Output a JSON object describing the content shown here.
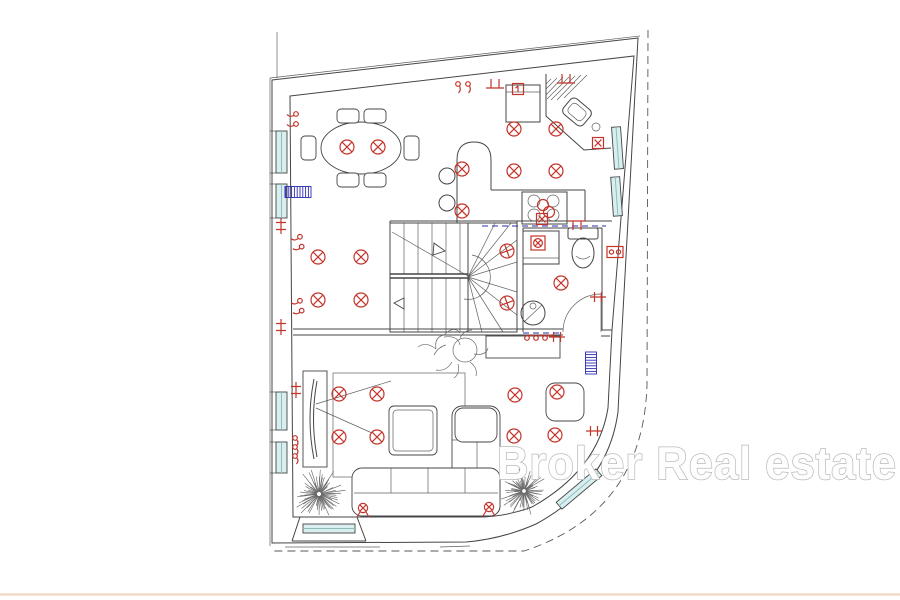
{
  "watermark": {
    "text": "Broker Real estate"
  },
  "canvas": {
    "width": 900,
    "height": 600,
    "background": "#ffffff"
  },
  "colors": {
    "line": "#454545",
    "red": "#c3342b",
    "navy": "#2b2bb2",
    "window": "#d9efef",
    "window_mid": "#8fbcbc",
    "page_rule": "#f2d8c6",
    "tree": "#6a6a6a",
    "watermark_stroke": "#b9b9b9",
    "watermark_fill": "#fefefe"
  },
  "legend": {
    "ceiling-light-icon": "red circle with diagonal cross = ceiling light point",
    "wall-lamp-icon": "red crossed circle with legs on wall = wall lamp",
    "socket-x-icon": "red box with X = power outlet",
    "socket-oo-icon": "red box with two circles = double socket",
    "switch-curl-icon": "red curls = light switches",
    "tick-icon": "red crossed tick = wall connection point",
    "fan-vent-icon": "red boxed fan in shower = extractor vent",
    "fridge-tag-icon": "red boxed 1 = appliance tag",
    "radiator-icon": "blue hatched bar = radiator",
    "window-glyph": "cyan band in wall = window",
    "tree-glyph": "hatched circle = tree / shrub"
  },
  "ceiling_lights": [
    [
      347,
      147
    ],
    [
      378,
      147
    ],
    [
      318,
      257
    ],
    [
      361,
      257
    ],
    [
      318,
      300
    ],
    [
      361,
      300
    ],
    [
      462,
      169
    ],
    [
      462,
      211
    ],
    [
      514,
      129
    ],
    [
      556,
      129
    ],
    [
      514,
      171
    ],
    [
      556,
      171
    ],
    [
      561,
      283
    ],
    [
      339,
      394
    ],
    [
      377,
      394
    ],
    [
      339,
      437
    ],
    [
      377,
      437
    ],
    [
      515,
      395
    ],
    [
      557,
      392
    ],
    [
      514,
      436
    ],
    [
      555,
      435
    ]
  ],
  "stair_lights": [
    [
      507,
      251
    ],
    [
      507,
      303
    ]
  ],
  "glyphs": [
    {
      "type": "curl2",
      "x": 464,
      "y": 86,
      "rot": 0
    },
    {
      "type": "tick-tt",
      "x": 495,
      "y": 85,
      "rot": 0
    },
    {
      "type": "tick-tt",
      "x": 566,
      "y": 80,
      "rot": 0
    },
    {
      "type": "curl2",
      "x": 294,
      "y": 120,
      "rot": 90
    },
    {
      "type": "tick-cross",
      "x": 281,
      "y": 226,
      "rot": 0
    },
    {
      "type": "curl2",
      "x": 299,
      "y": 243,
      "rot": 80
    },
    {
      "type": "curl2",
      "x": 299,
      "y": 307,
      "rot": 80
    },
    {
      "type": "tick-cross",
      "x": 281,
      "y": 327,
      "rot": 0
    },
    {
      "type": "tick-cross",
      "x": 296,
      "y": 390,
      "rot": 0
    },
    {
      "type": "curl3",
      "x": 295,
      "y": 447,
      "rot": 0
    },
    {
      "type": "wall-lamp",
      "x": 363,
      "y": 508,
      "rot": 0
    },
    {
      "type": "wall-lamp",
      "x": 489,
      "y": 507,
      "rot": 0
    },
    {
      "type": "curl3",
      "x": 536,
      "y": 338,
      "rot": -90
    },
    {
      "type": "tick-cross",
      "x": 557,
      "y": 337,
      "rot": 90
    },
    {
      "type": "sock-x",
      "x": 598,
      "y": 143,
      "rot": 0
    },
    {
      "type": "sock-oo",
      "x": 615,
      "y": 252,
      "rot": 0
    },
    {
      "type": "sock-x",
      "x": 542,
      "y": 219,
      "rot": 0
    },
    {
      "type": "tick-tt",
      "x": 577,
      "y": 224,
      "rot": 180
    },
    {
      "type": "tick-cross",
      "x": 598,
      "y": 297,
      "rot": 90
    },
    {
      "type": "tick-cross",
      "x": 594,
      "y": 431,
      "rot": 90
    },
    {
      "type": "fan",
      "x": 538,
      "y": 243,
      "rot": 0
    },
    {
      "type": "fridge-tag",
      "x": 518,
      "y": 89,
      "rot": 0
    }
  ],
  "radiators": [
    {
      "x": 298,
      "y": 192,
      "h": 26,
      "rot": 90
    },
    {
      "x": 591,
      "y": 363,
      "h": 22,
      "rot": 0
    }
  ],
  "trees": [
    {
      "x": 319,
      "y": 494,
      "r": 27
    },
    {
      "x": 524,
      "y": 491,
      "r": 25
    }
  ]
}
